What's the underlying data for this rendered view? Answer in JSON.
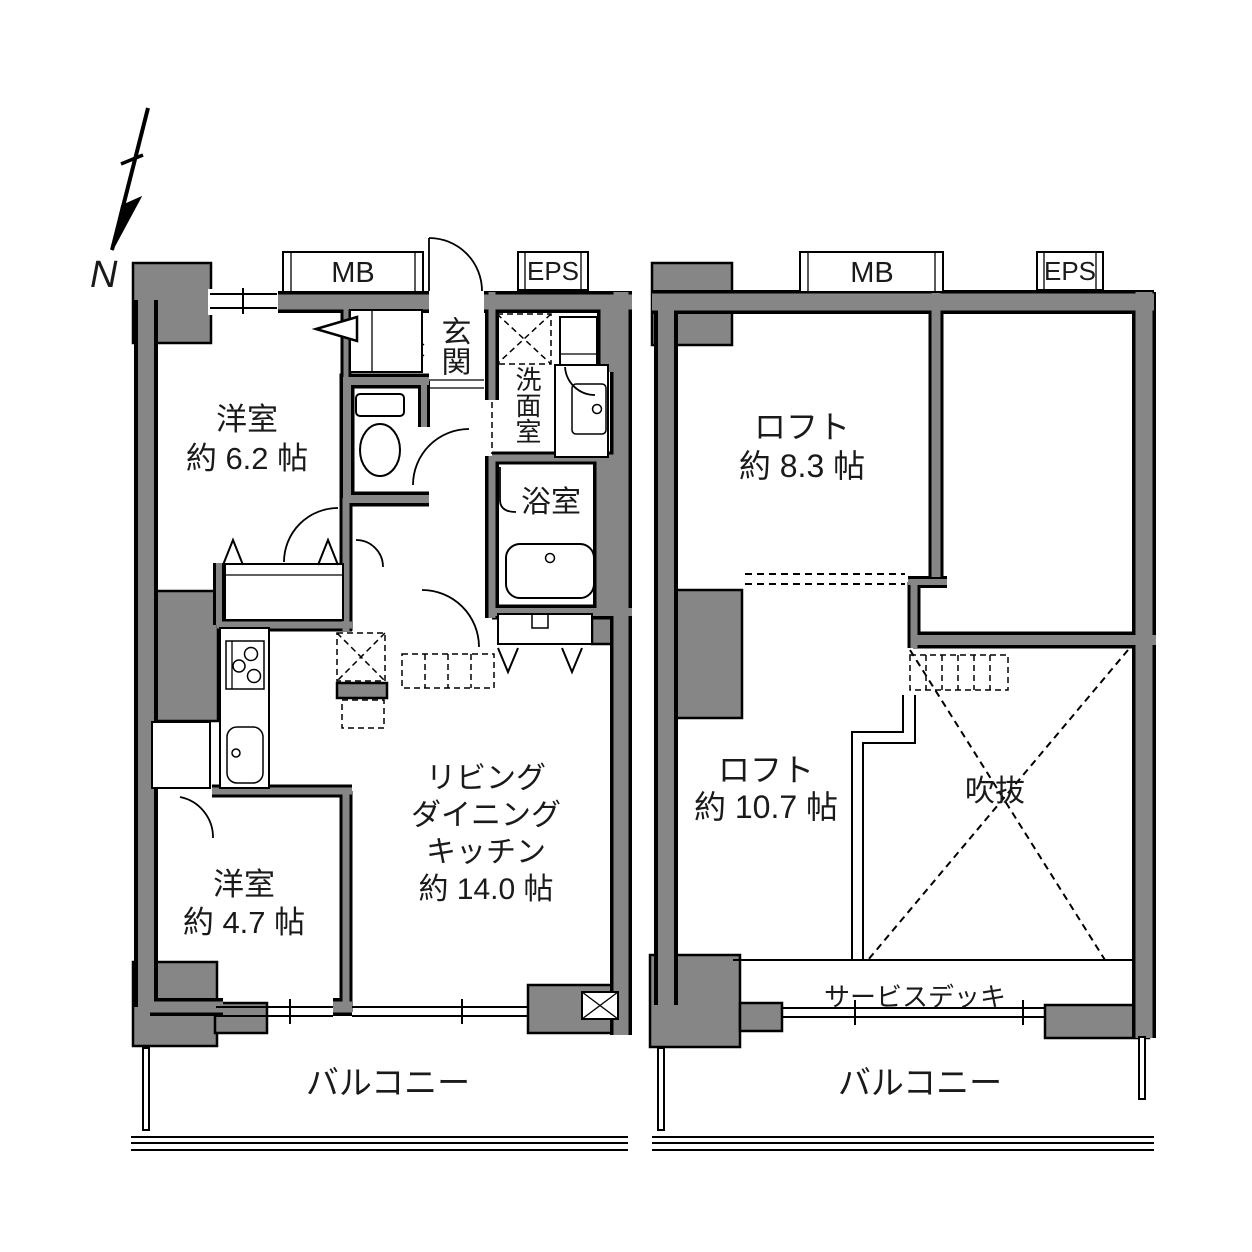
{
  "colors": {
    "wall_fill": "#868686",
    "line": "#000000",
    "background": "#ffffff"
  },
  "compass": {
    "north_label": "N"
  },
  "floor1": {
    "mb": "MB",
    "eps": "EPS",
    "entrance": "玄関",
    "washroom": "洗面室",
    "bathroom": "浴室",
    "bedroom_a": {
      "name": "洋室",
      "size": "約 6.2 帖"
    },
    "bedroom_b": {
      "name": "洋室",
      "size": "約 4.7 帖"
    },
    "ldk": {
      "line1": "リビング",
      "line2": "ダイニング",
      "line3": "キッチン",
      "size": "約 14.0 帖"
    },
    "balcony": "バルコニー"
  },
  "floor2": {
    "mb": "MB",
    "eps": "EPS",
    "loft_a": {
      "name": "ロフト",
      "size": "約 8.3 帖"
    },
    "loft_b": {
      "name": "ロフト",
      "size": "約 10.7 帖"
    },
    "void": "吹抜",
    "service_deck": "サービスデッキ",
    "balcony": "バルコニー"
  }
}
